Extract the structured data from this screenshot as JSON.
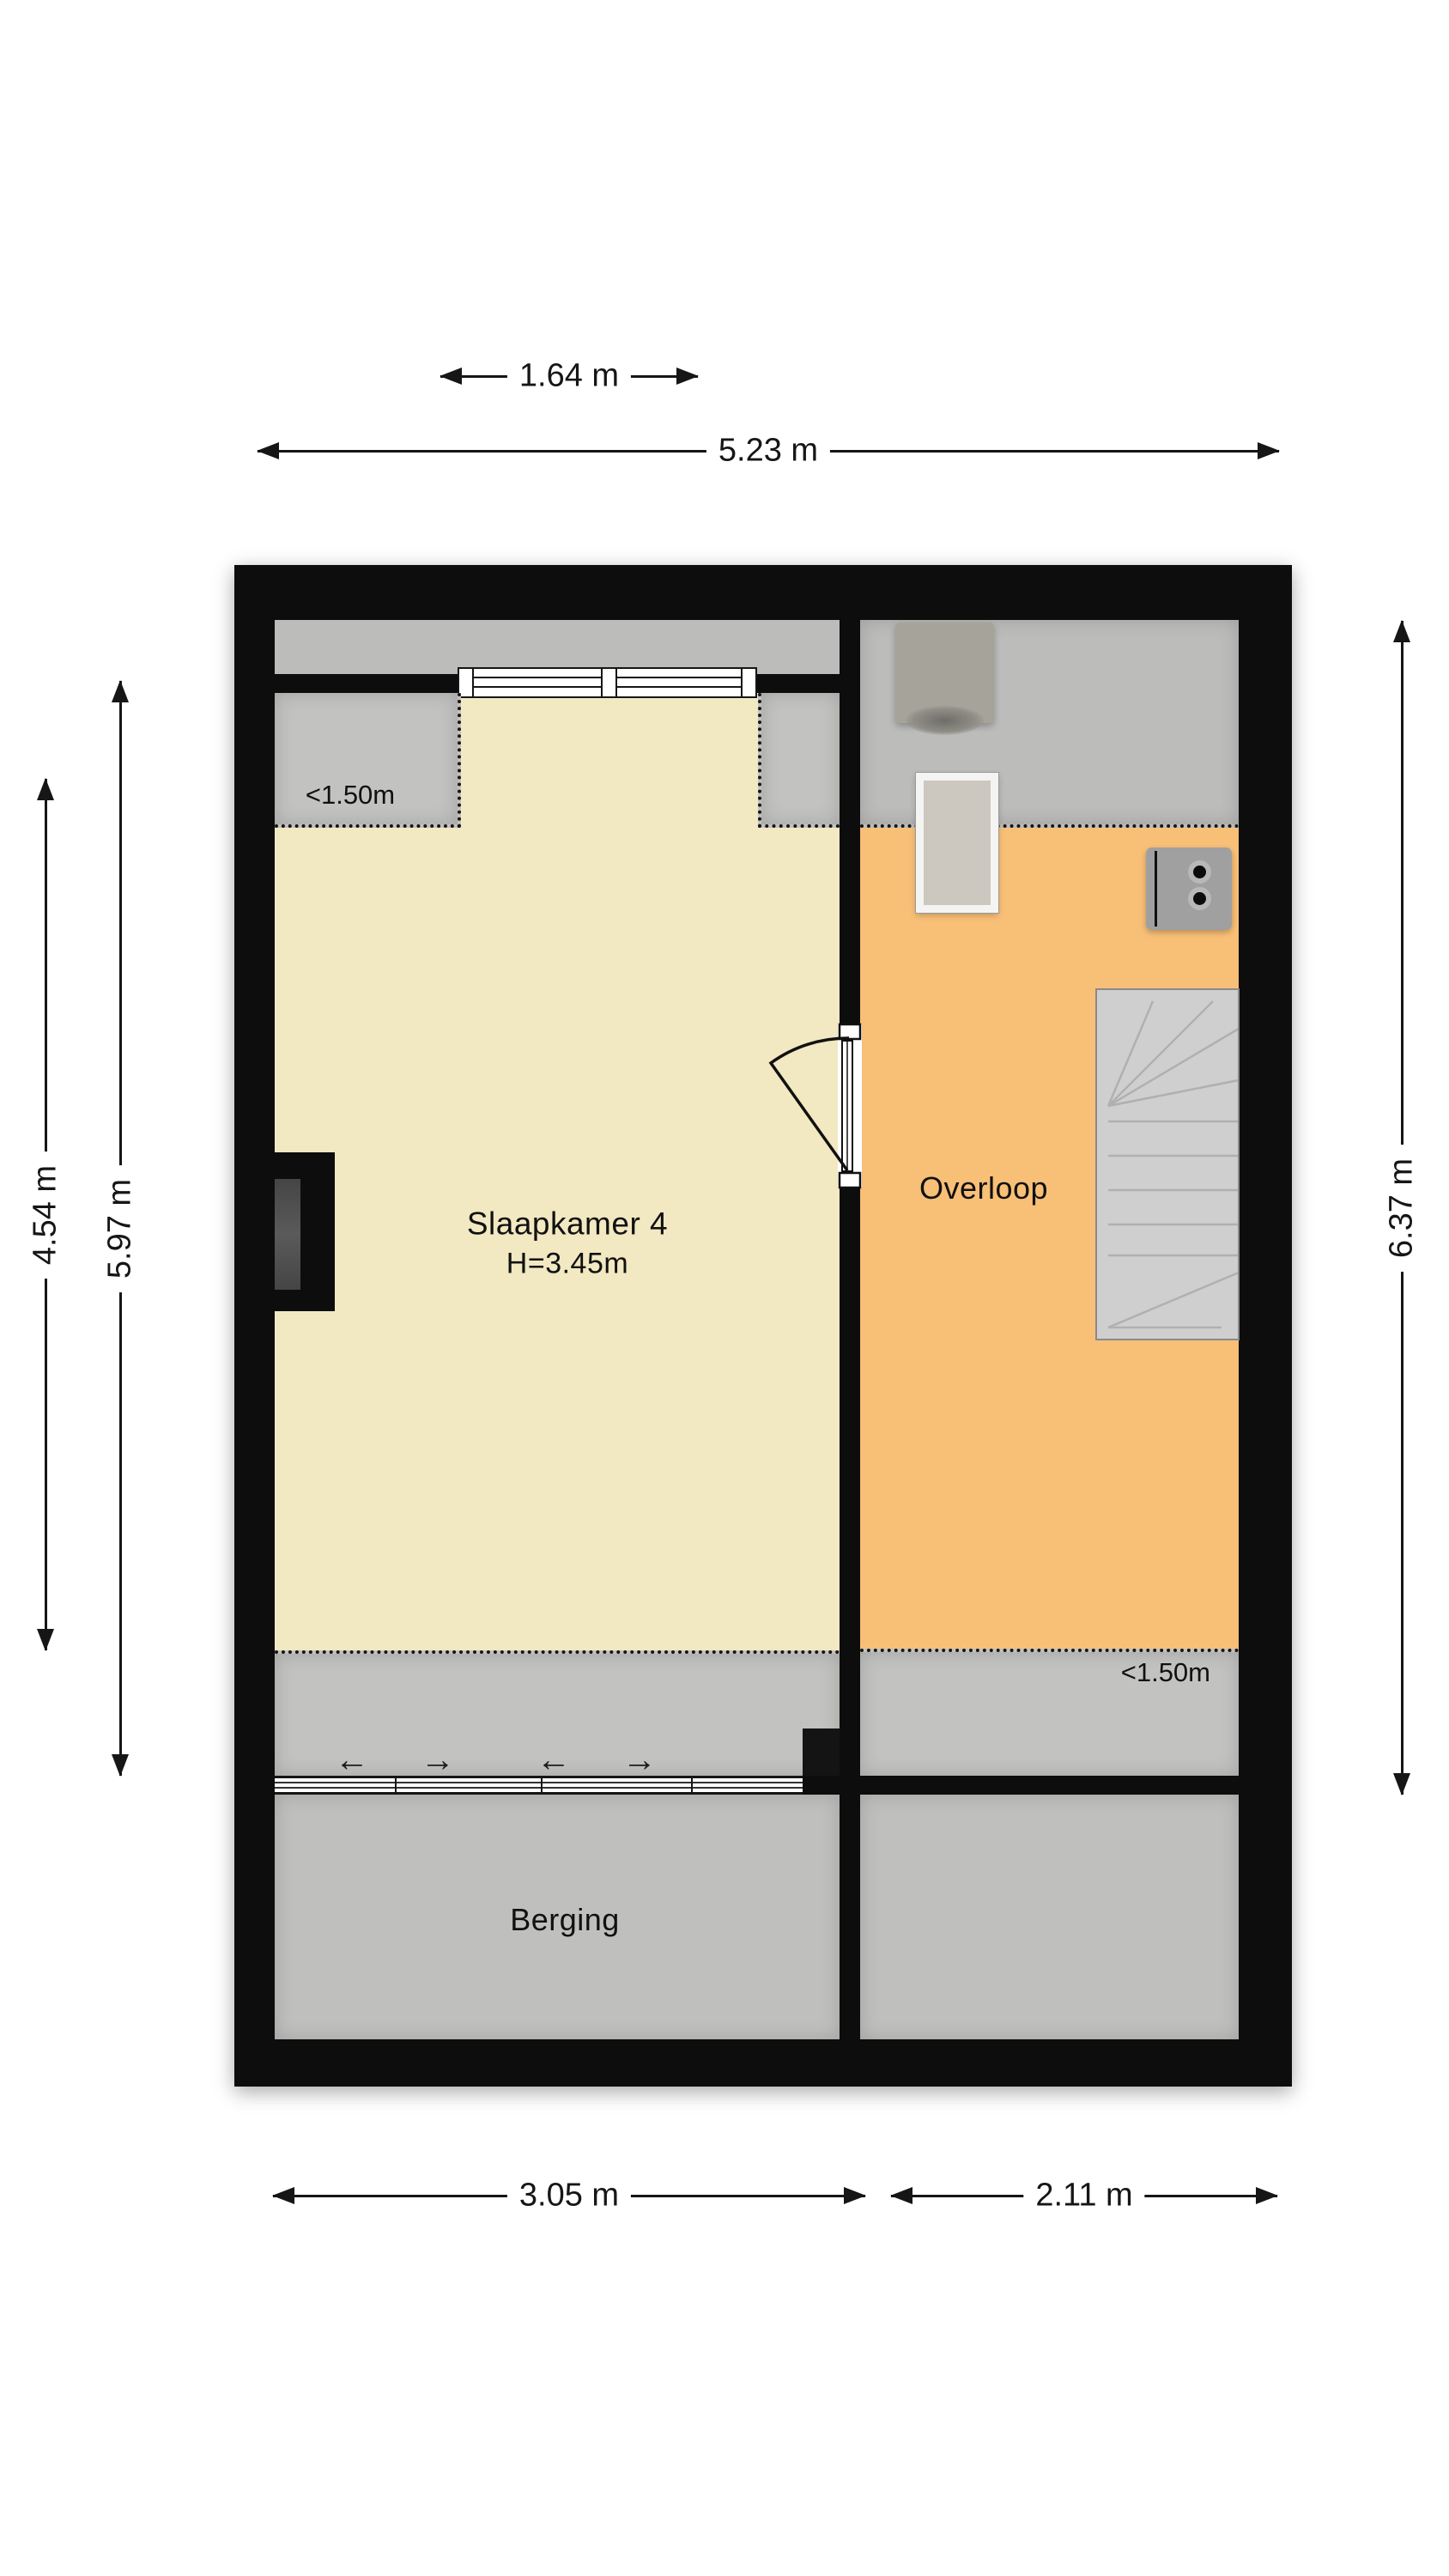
{
  "title": "Floor plan - second floor",
  "rooms": {
    "bedroom": {
      "name": "Slaapkamer 4",
      "ceiling": "H=3.45m"
    },
    "landing": {
      "name": "Overloop"
    },
    "storage": {
      "name": "Berging"
    }
  },
  "annotations": {
    "low_clearance_left": "<1.50m",
    "low_clearance_right": "<1.50m"
  },
  "dimensions": {
    "window_width": "1.64 m",
    "total_width": "5.23 m",
    "bedroom_inner_height": "4.54 m",
    "bedroom_full_height": "5.97 m",
    "landing_height": "6.37 m",
    "storage_width": "3.05 m",
    "bottom_right_width": "2.11 m"
  },
  "slide_arrows": [
    "←",
    "→",
    "←",
    "→"
  ],
  "symbols": [
    "window",
    "door-swing",
    "stairs",
    "cabinet",
    "table",
    "wall-socket",
    "chimney"
  ],
  "colors": {
    "wall": "#0d0d0d",
    "cream": "#f2e8c1",
    "orange": "#f8bf77",
    "zonegray": "#c2c2c0",
    "stripgray": "#bcbcbb",
    "storagegray": "#bfbfbd",
    "stairfill": "#cfcfcf",
    "furngray": "#a6a39b",
    "paper": "#ffffff"
  }
}
